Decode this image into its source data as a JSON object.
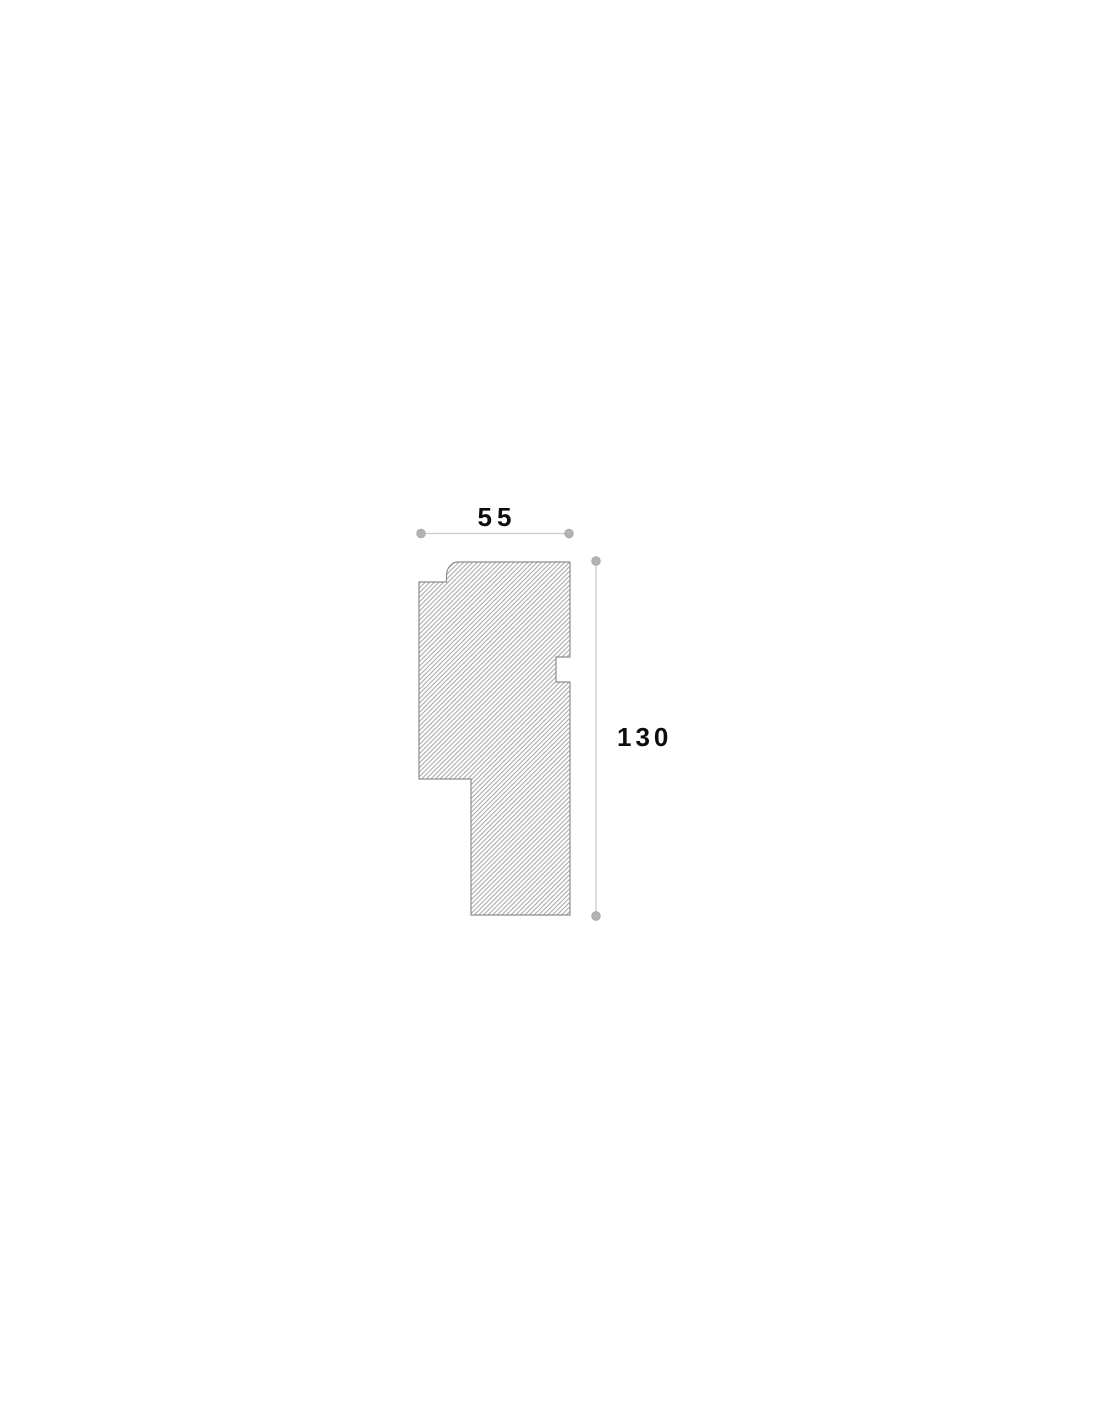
{
  "diagram": {
    "kind": "moulding-profile-cross-section",
    "dimensions": {
      "width_label": "55",
      "height_label": "130"
    },
    "colors": {
      "background": "#ffffff",
      "outline": "#8e8e8e",
      "hatch": "#9f9f9f",
      "dimension_line": "#cbcbcb",
      "dimension_dot_fill": "#b3b3b3",
      "dimension_dot_edge": "#a4a4a4",
      "label_text": "#0d0d0d"
    }
  }
}
